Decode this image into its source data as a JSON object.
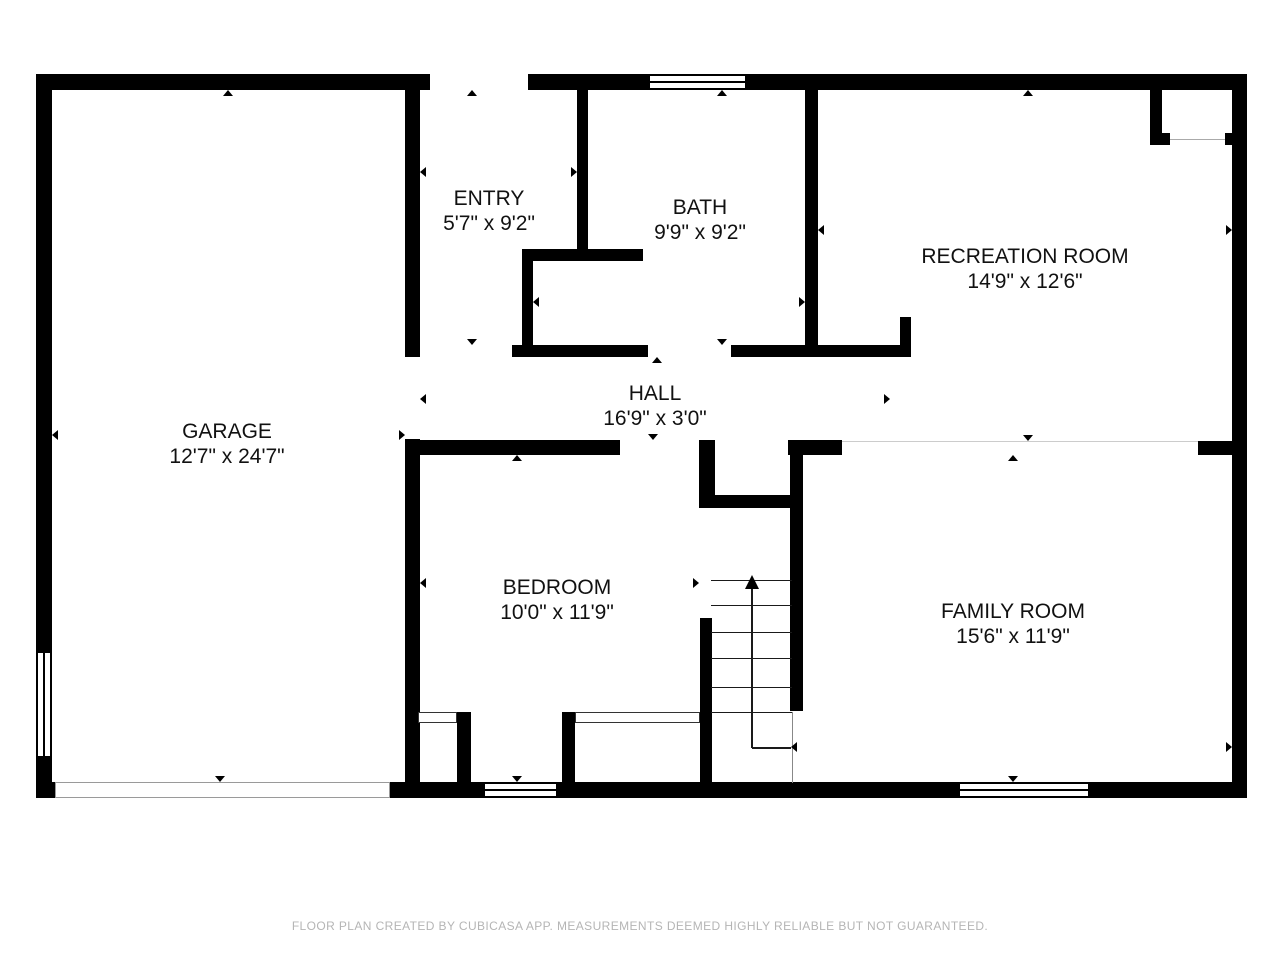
{
  "rooms": [
    {
      "id": "garage",
      "name": "GARAGE",
      "dims": "12'7\" x 24'7\"",
      "cx": 227,
      "cy": 444
    },
    {
      "id": "entry",
      "name": "ENTRY",
      "dims": "5'7\" x 9'2\"",
      "cx": 489,
      "cy": 211
    },
    {
      "id": "bath",
      "name": "BATH",
      "dims": "9'9\" x 9'2\"",
      "cx": 700,
      "cy": 220
    },
    {
      "id": "recreation-room",
      "name": "RECREATION ROOM",
      "dims": "14'9\" x 12'6\"",
      "cx": 1025,
      "cy": 269
    },
    {
      "id": "hall",
      "name": "HALL",
      "dims": "16'9\" x 3'0\"",
      "cx": 655,
      "cy": 406
    },
    {
      "id": "bedroom",
      "name": "BEDROOM",
      "dims": "10'0\" x 11'9\"",
      "cx": 557,
      "cy": 600
    },
    {
      "id": "family-room",
      "name": "FAMILY ROOM",
      "dims": "15'6\" x 11'9\"",
      "cx": 1013,
      "cy": 624
    }
  ],
  "stairs": {
    "direction": "up"
  },
  "footer": {
    "text": "FLOOR PLAN CREATED BY CUBICASA APP. MEASUREMENTS DEEMED HIGHLY RELIABLE BUT NOT GUARANTEED."
  },
  "colors": {
    "wall": "#000000",
    "background": "#ffffff",
    "footer_text": "#b5b5b5",
    "open_boundary_line": "#cccccc"
  }
}
